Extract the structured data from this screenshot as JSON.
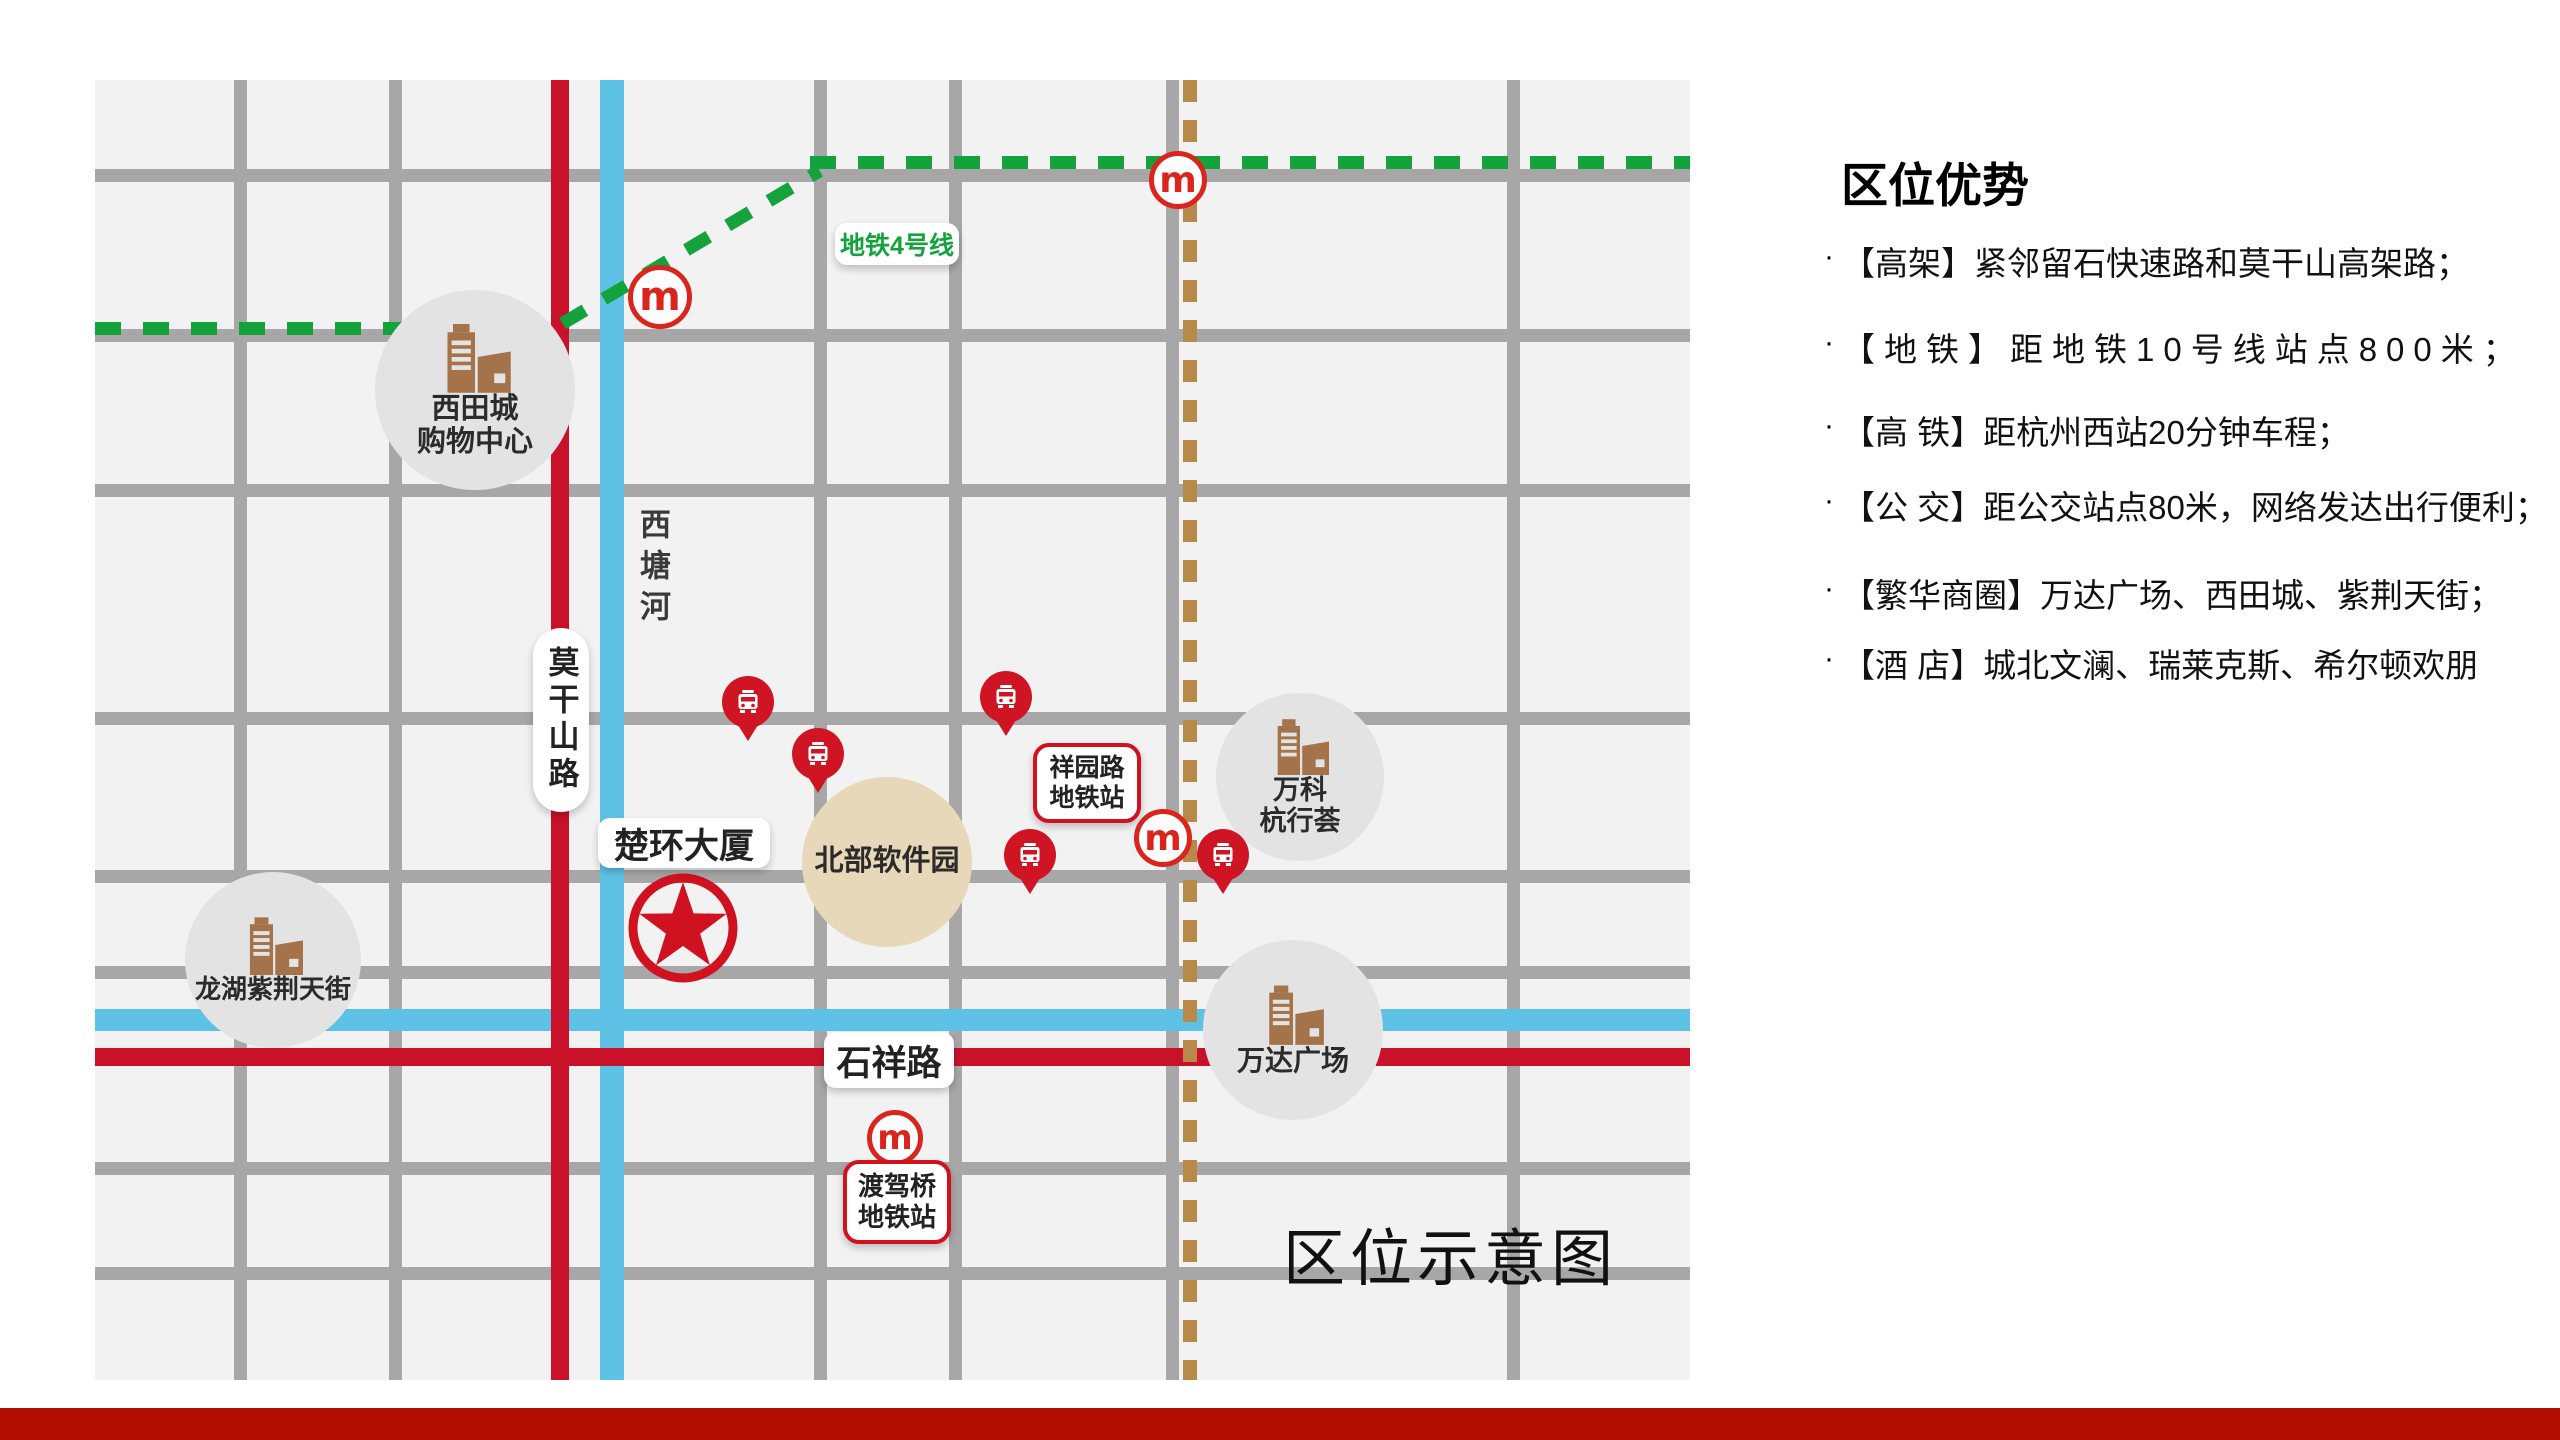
{
  "panel": {
    "title": "区位优势",
    "bullet": "·",
    "items": [
      {
        "text": "【高架】紧邻留石快速路和莫干山高架路；"
      },
      {
        "text": "【地铁】距地铁10号线站点800米；"
      },
      {
        "text": "【高 铁】距杭州西站20分钟车程；"
      },
      {
        "text": "【公 交】距公交站点80米，网络发达出行便利；"
      },
      {
        "text": "【繁华商圈】万达广场、西田城、紫荆天街；"
      },
      {
        "text": "【酒 店】城北文澜、瑞莱克斯、希尔顿欢朋"
      }
    ]
  },
  "map": {
    "caption": "区位示意图",
    "metro_line_label": "地铁4号线",
    "metro_logo_letter": "m",
    "road_label_vertical": "莫干山路",
    "road_label_horizontal": "石祥路",
    "river_label": "西塘河",
    "project_label": "楚环大厦",
    "stations": [
      {
        "line1": "祥园路",
        "line2": "地铁站"
      },
      {
        "line1": "渡驾桥",
        "line2": "地铁站"
      }
    ],
    "pois": [
      {
        "line1": "西田城",
        "line2": "购物中心"
      },
      {
        "line1": "龙湖紫荆天街",
        "line2": ""
      },
      {
        "line1": "万科",
        "line2": "杭行荟"
      },
      {
        "line1": "万达广场",
        "line2": ""
      },
      {
        "line1": "北部软件园",
        "line2": ""
      }
    ]
  },
  "colors": {
    "map_bg": "#f2f2f2",
    "road_gray": "#a7a7a7",
    "road_red": "#c9112a",
    "river_blue": "#5ec2e6",
    "metro4_green": "#14a23c",
    "metro10_brown_dash": "#b9894c",
    "marker_red": "#cf1523",
    "building_brown": "#a5734a",
    "poi_gray": "#e3e3e3",
    "softpark_beige": "#e7d8b9",
    "bottom_bar_red": "#b20b00"
  }
}
